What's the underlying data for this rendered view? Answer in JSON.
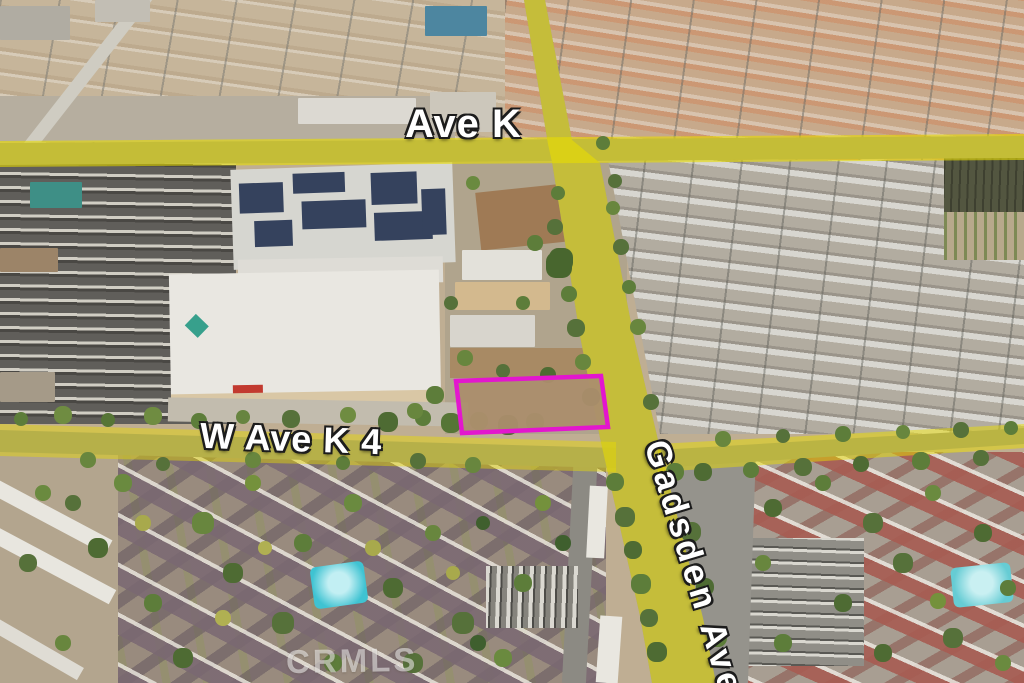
{
  "map": {
    "street_labels": {
      "ave_k": "Ave K",
      "w_ave_k_4": "W Ave K 4",
      "gadsden_ave": "Gadsden Ave"
    },
    "watermark": "CRMLS",
    "colors": {
      "road_highlight": "#e8dc00",
      "parcel_outline": "#e316ce"
    }
  }
}
